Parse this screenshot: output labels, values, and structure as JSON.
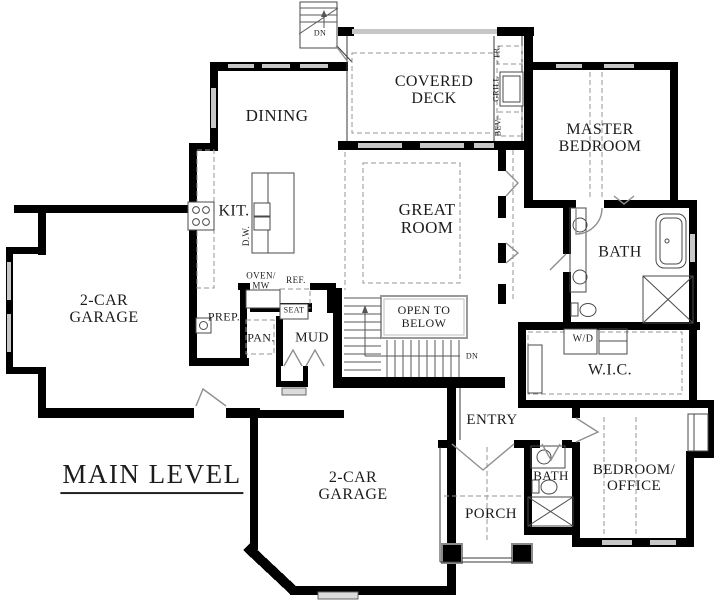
{
  "meta": {
    "type": "architectural-floor-plan",
    "width": 720,
    "height": 606
  },
  "title": {
    "label": "MAIN LEVEL"
  },
  "colors": {
    "wall": "#000000",
    "window": "#c7c7c7",
    "dashed_line": "#949494",
    "text": "#1c1c1c"
  },
  "rooms": {
    "covered_deck": {
      "label": "COVERED\nDECK"
    },
    "dining": {
      "label": "DINING"
    },
    "master_bedroom": {
      "label": "MASTER\nBEDROOM"
    },
    "kitchen": {
      "label": "KIT."
    },
    "great_room": {
      "label": "GREAT\nROOM"
    },
    "master_bath": {
      "label": "BATH"
    },
    "garage_left": {
      "label": "2-CAR\nGARAGE"
    },
    "prep": {
      "label": "PREP."
    },
    "pantry": {
      "label": "PAN."
    },
    "mud": {
      "label": "MUD"
    },
    "wic": {
      "label": "W.I.C."
    },
    "entry": {
      "label": "ENTRY"
    },
    "bath2": {
      "label": "BATH"
    },
    "porch": {
      "label": "PORCH"
    },
    "bedroom_office": {
      "label": "BEDROOM/\nOFFICE"
    },
    "garage_lower": {
      "label": "2-CAR\nGARAGE"
    }
  },
  "annotations": {
    "open_to_below": "OPEN TO\nBELOW",
    "dn_stairs": "DN",
    "dn_deck": "DN",
    "oven_mw": "OVEN/\nMW",
    "ref": "REF.",
    "seat": "SEAT",
    "dw": "D.W.",
    "wd": "W/D",
    "tr": "TR.",
    "grill": "GRILL",
    "bev": "BEV."
  }
}
